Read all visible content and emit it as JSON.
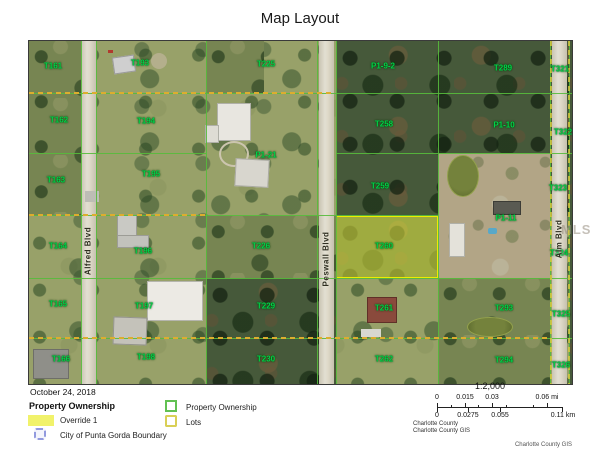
{
  "title": "Map Layout",
  "map": {
    "watermark": "MLS",
    "parcels": [
      {
        "label": "T161",
        "x": 24,
        "y": 25
      },
      {
        "label": "T193",
        "x": 111,
        "y": 22
      },
      {
        "label": "T225",
        "x": 237,
        "y": 23
      },
      {
        "label": "P1-9-2",
        "x": 354,
        "y": 25
      },
      {
        "label": "T289",
        "x": 474,
        "y": 27
      },
      {
        "label": "T321",
        "x": 531,
        "y": 28
      },
      {
        "label": "T162",
        "x": 30,
        "y": 79
      },
      {
        "label": "T194",
        "x": 117,
        "y": 80
      },
      {
        "label": "T258",
        "x": 355,
        "y": 83
      },
      {
        "label": "P1-10",
        "x": 475,
        "y": 84
      },
      {
        "label": "T322",
        "x": 534,
        "y": 91
      },
      {
        "label": "P1-21",
        "x": 237,
        "y": 114
      },
      {
        "label": "T163",
        "x": 27,
        "y": 139
      },
      {
        "label": "T195",
        "x": 122,
        "y": 133
      },
      {
        "label": "T259",
        "x": 351,
        "y": 145
      },
      {
        "label": "T323",
        "x": 529,
        "y": 147
      },
      {
        "label": "T164",
        "x": 29,
        "y": 205
      },
      {
        "label": "T196",
        "x": 114,
        "y": 210
      },
      {
        "label": "T226",
        "x": 232,
        "y": 205
      },
      {
        "label": "T260",
        "x": 355,
        "y": 205,
        "highlighted": true
      },
      {
        "label": "P1-11",
        "x": 477,
        "y": 177
      },
      {
        "label": "T324",
        "x": 530,
        "y": 212
      },
      {
        "label": "T165",
        "x": 29,
        "y": 263
      },
      {
        "label": "T197",
        "x": 115,
        "y": 265
      },
      {
        "label": "T229",
        "x": 237,
        "y": 265
      },
      {
        "label": "T261",
        "x": 355,
        "y": 267
      },
      {
        "label": "T293",
        "x": 475,
        "y": 267
      },
      {
        "label": "T325",
        "x": 532,
        "y": 273
      },
      {
        "label": "T166",
        "x": 32,
        "y": 318
      },
      {
        "label": "T198",
        "x": 117,
        "y": 316
      },
      {
        "label": "T230",
        "x": 237,
        "y": 318
      },
      {
        "label": "T262",
        "x": 355,
        "y": 318
      },
      {
        "label": "T294",
        "x": 475,
        "y": 319
      },
      {
        "label": "T326",
        "x": 532,
        "y": 324
      }
    ],
    "roads": [
      {
        "name": "Alfred Blvd",
        "x": 59,
        "y": 210
      },
      {
        "name": "Peswall Blvd",
        "x": 297,
        "y": 218
      },
      {
        "name": "Alm Blvd",
        "x": 530,
        "y": 198
      }
    ]
  },
  "legend": {
    "date": "October 24, 2018",
    "heading": "Property Ownership",
    "override_label": "Override 1",
    "city_boundary_label": "City of Punta Gorda Boundary",
    "property_label": "Property Ownership",
    "lots_label": "Lots"
  },
  "scalebar": {
    "ratio": "1:2,000",
    "mi_ticks": [
      {
        "text": "0",
        "x": 0
      },
      {
        "text": "0.015",
        "x": 28
      },
      {
        "text": "0.03",
        "x": 55
      },
      {
        "text": "0.06 mi",
        "x": 110
      }
    ],
    "km_ticks": [
      {
        "text": "0",
        "x": 0
      },
      {
        "text": "0.0275",
        "x": 31
      },
      {
        "text": "0.055",
        "x": 63
      },
      {
        "text": "0.11 km",
        "x": 126
      }
    ],
    "credit_line1": "Charlotte County",
    "credit_line2": "Charlotte County GIS",
    "footer_credit": "Charlotte County GIS"
  },
  "colors": {
    "parcel_line": "#56bb3c",
    "lots_dash": "#dcae2e",
    "override_fill": "#f1f26b",
    "city_boundary": "#929ade",
    "label_green": "#00d24a"
  }
}
